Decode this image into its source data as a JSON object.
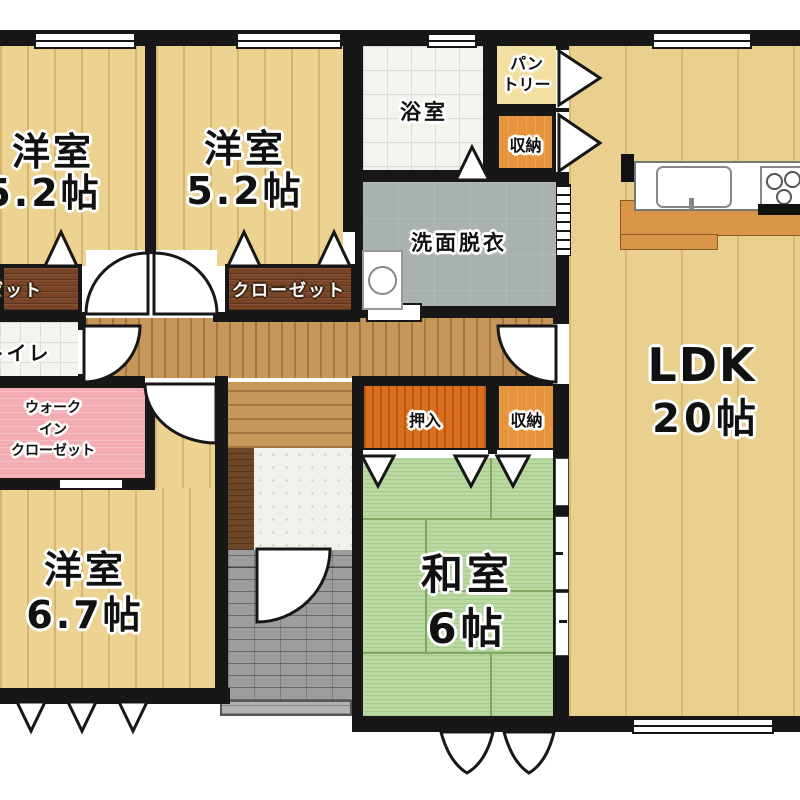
{
  "floor_plan": {
    "rooms": {
      "western1": {
        "name": "洋室",
        "area": "5.2帖"
      },
      "western2": {
        "name": "洋室",
        "area": "5.2帖"
      },
      "western3": {
        "name": "洋室",
        "area": "6.7帖"
      },
      "japanese": {
        "name": "和室",
        "area": "6帖"
      },
      "ldk": {
        "name": "LDK",
        "area": "20帖"
      },
      "bathroom": {
        "name": "浴室"
      },
      "washroom": {
        "name": "洗面脱衣"
      },
      "toilet": {
        "name": "トイレ"
      },
      "pantry": {
        "line1": "パン",
        "line2": "トリー"
      },
      "storage_upper": {
        "name": "収納"
      },
      "storage_lower": {
        "name": "収納"
      },
      "oshiire": {
        "name": "押入"
      },
      "walk_in_closet": {
        "line1": "ウォーク",
        "line2": "イン",
        "line3": "クローゼット"
      },
      "closet_left": {
        "name": "クローゼット"
      },
      "closet_center": {
        "name": "クローゼット"
      }
    },
    "colors": {
      "wall": "#171717",
      "wood_floor": "#ECD391",
      "ldk_floor": "#EAD08E",
      "corridor": "#C69759",
      "tatami": "#BAD8A1",
      "oshiire": "#D96F1E",
      "storage": "#E6943C",
      "pantry": "#F4DFA2",
      "walk_in_closet": "#F2ABB1",
      "closet": "#7A4527",
      "washroom": "#A9B2AE",
      "bath_tile": "#F4F4EF",
      "porch": "#9D9D9D"
    }
  }
}
